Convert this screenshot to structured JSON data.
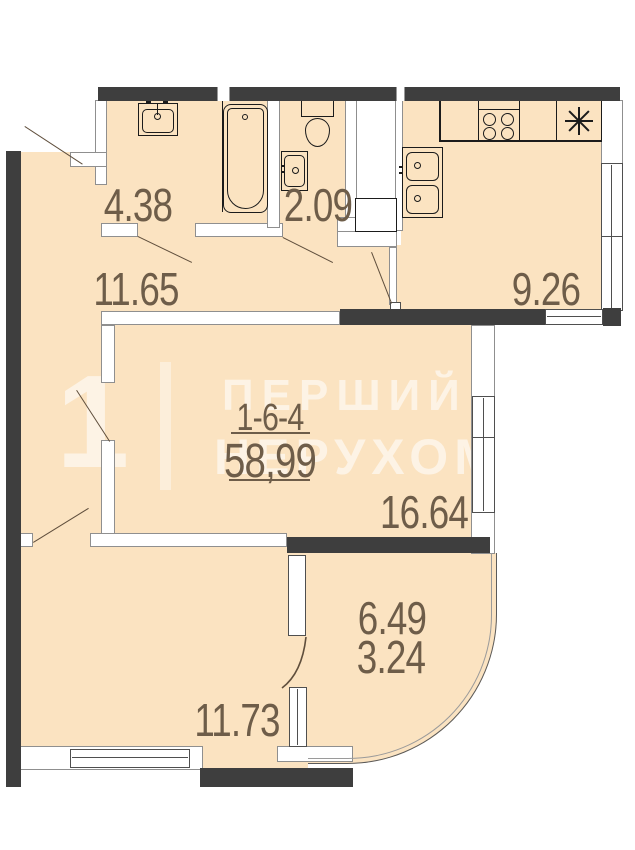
{
  "unit": {
    "code": "1-6-4",
    "total_area": "58,99"
  },
  "rooms": {
    "bathroom": "4.38",
    "toilet": "2.09",
    "hallway": "11.65",
    "kitchen": "9.26",
    "living": "16.64",
    "balcony_full": "6.49",
    "balcony_reduced": "3.24",
    "bedroom": "11.73"
  },
  "watermark": {
    "logo_digit": "1",
    "line1": "ПЕРШИЙ БА",
    "line2": "НЕРУХОМО"
  },
  "colors": {
    "floor": "#fbe3c1",
    "wall": "#3e3e3e",
    "fixture_line": "#1b1b1b",
    "label_text": "#6e5d49",
    "watermark": "rgba(255,255,255,0.58)"
  },
  "icons": {
    "bath_sink": "sink with faucet",
    "bathtub": "bathtub with drain",
    "toilet": "toilet with tank",
    "washbasin": "small wall basin",
    "stove": "4-burner cooktop",
    "fridge": "snowflake asterisk",
    "kitchen_sink": "double bowl sink",
    "doors": "quarter-swing door lines",
    "windows": "double-line windows"
  }
}
